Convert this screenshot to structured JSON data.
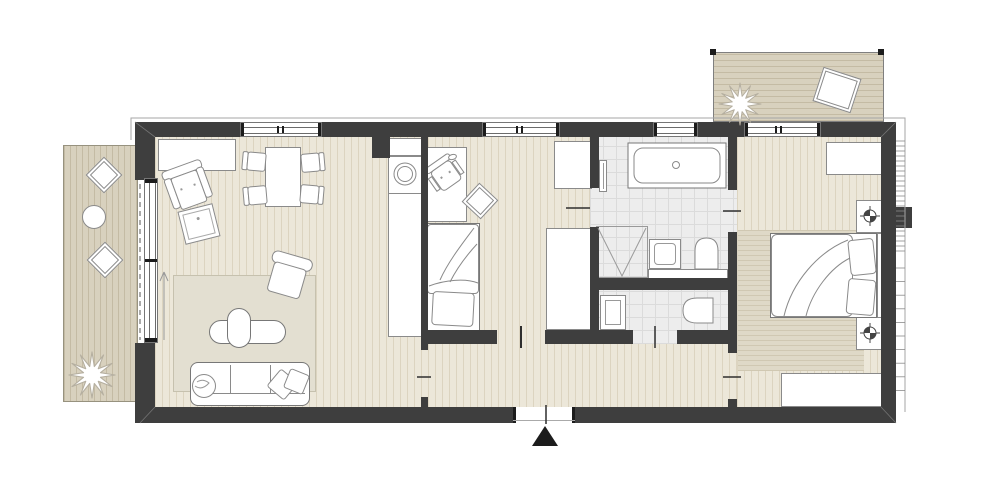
{
  "document": {
    "kind": "architectural-floor-plan",
    "visible_text": []
  },
  "colors": {
    "wall": "#3e3e3e",
    "outline": "#9a9a9a",
    "floor": "#ece7d9",
    "floor_line": "#dcd4c0",
    "deck": "#d8d1be",
    "deck_line": "#c4bba4",
    "tile": "#ededed",
    "tile_line": "#dbdbdb",
    "rug": "#e3dfd1",
    "rug_line": "#d0c8b2",
    "rug_bg": "#dfd9c7",
    "stroke": "#8a8a8a",
    "dark": "#444444",
    "black": "#1c1c1c",
    "white": "#ffffff"
  },
  "icons": {
    "entrance-marker-icon": "filled-black-triangle",
    "plant-icon": "white-star-burst",
    "heating-point-icon": "circled-crosshair-with-filled-quadrants",
    "washing-machine-icon": "double-circle",
    "shower-icon": "square-with-v-diagonals",
    "door-swing-icon": "short-tick-line"
  }
}
